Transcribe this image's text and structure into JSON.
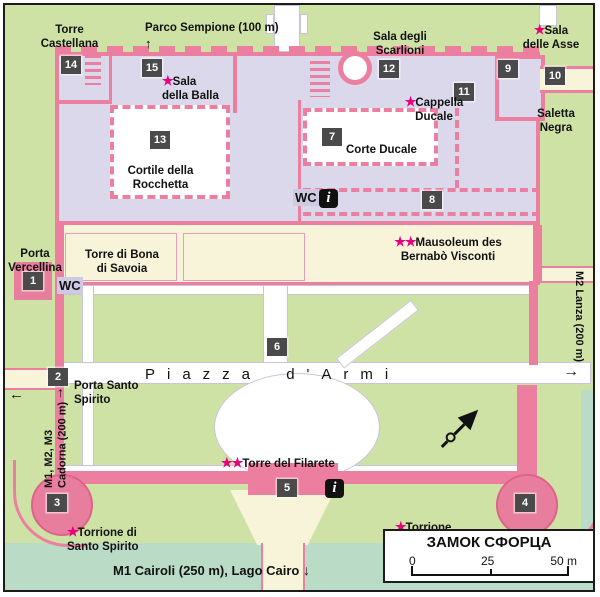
{
  "legend": {
    "title": "ЗАМОК СФОРЦА",
    "scale_ticks": [
      "0",
      "25",
      "50 m"
    ]
  },
  "icons": {
    "star": "★",
    "info_icon": "i",
    "arrow_up": "↑",
    "arrow_down": "↓",
    "arrow_left": "←",
    "arrow_right": "→"
  },
  "markers": {
    "m1": "1",
    "m2": "2",
    "m3": "3",
    "m4": "4",
    "m5": "5",
    "m6": "6",
    "m7": "7",
    "m8": "8",
    "m9": "9",
    "m10": "10",
    "m11": "11",
    "m12": "12",
    "m13": "13",
    "m14": "14",
    "m15": "15"
  },
  "places": {
    "torre_castellana": "Torre\nCastellana",
    "parco_sempione": "Parco Sempione (100 m)",
    "sala_della_balla": "Sala\ndella Balla",
    "sala_degli_scarlioni": "Sala degli\nScarlioni",
    "sala_delle_asse": "Sala\ndelle Asse",
    "cappella_ducale": "Cappella\nDucale",
    "saletta_negra": "Saletta\nNegra",
    "corte_ducale": "Corte Ducale",
    "cortile_della_rocchetta": "Cortile della\nRocchetta",
    "wc": "WC",
    "mausoleum": "Mausoleum des\nBernabò Visconti",
    "porta_vercellina": "Porta\nVercellina",
    "torre_di_bona": "Torre di Bona\ndi Savoia",
    "m2_lanza": "M2 Lanza (200 m)",
    "porta_santo_spirito": "Porta Santo\nSpirito",
    "piazza_d_armi": "Piazza d'Armi",
    "cadorna": "M1, M2, M3\nCadorna (200 m)",
    "torre_del_filarete": "Torre del Filarete",
    "torrione_santo_spirito": "Torrione di\nSanto Spirito",
    "torrione_dei_carmine": "Torrione\ndei Carmine",
    "cairoli": "M1 Cairoli (250 m), Lago Cairo"
  },
  "colors": {
    "wall_pink": "#ec7fa0",
    "accent_magenta": "#e6007d",
    "park_green": "#cfe2a5",
    "building_lavender": "#dcd8eb",
    "courtyard_white": "#ffffff",
    "ward_cream": "#f7f4da",
    "water_teal": "#badcc6",
    "marker_gray": "#4a4a4a"
  }
}
